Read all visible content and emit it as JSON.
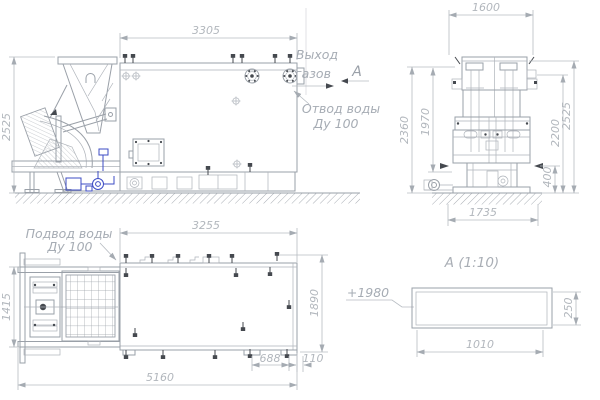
{
  "annotations": {
    "gas_outlet": {
      "line1": "Выход",
      "line2": "газов"
    },
    "water_outlet": {
      "line1": "Отвод воды",
      "line2": "Ду 100"
    },
    "water_inlet": {
      "line1": "Подвод воды",
      "line2": "Ду 100"
    },
    "section_letter": "А",
    "section_title": "А  (1:10)",
    "elevation_mark": "+1980"
  },
  "dimensions": {
    "side_view": {
      "top_width": "3305",
      "overall_height": "2525"
    },
    "front_view": {
      "top_width": "1600",
      "left_outer_height": "2360",
      "left_inner_height": "1970",
      "right_base_height": "400",
      "right_mid_height": "2200",
      "right_overall_height": "2525",
      "foundation_width": "1735"
    },
    "plan_view": {
      "body_length": "3255",
      "tipper_width": "1415",
      "body_width": "1890",
      "support_spacing": "688",
      "edge_offset": "110",
      "overall_length": "5160"
    },
    "section_view": {
      "width": "1010",
      "height": "250"
    }
  },
  "colors": {
    "line": "#9aa0a8",
    "dimension": "#b6bbc1",
    "accent_blue": "#3d4cc4",
    "dark": "#45494f"
  }
}
